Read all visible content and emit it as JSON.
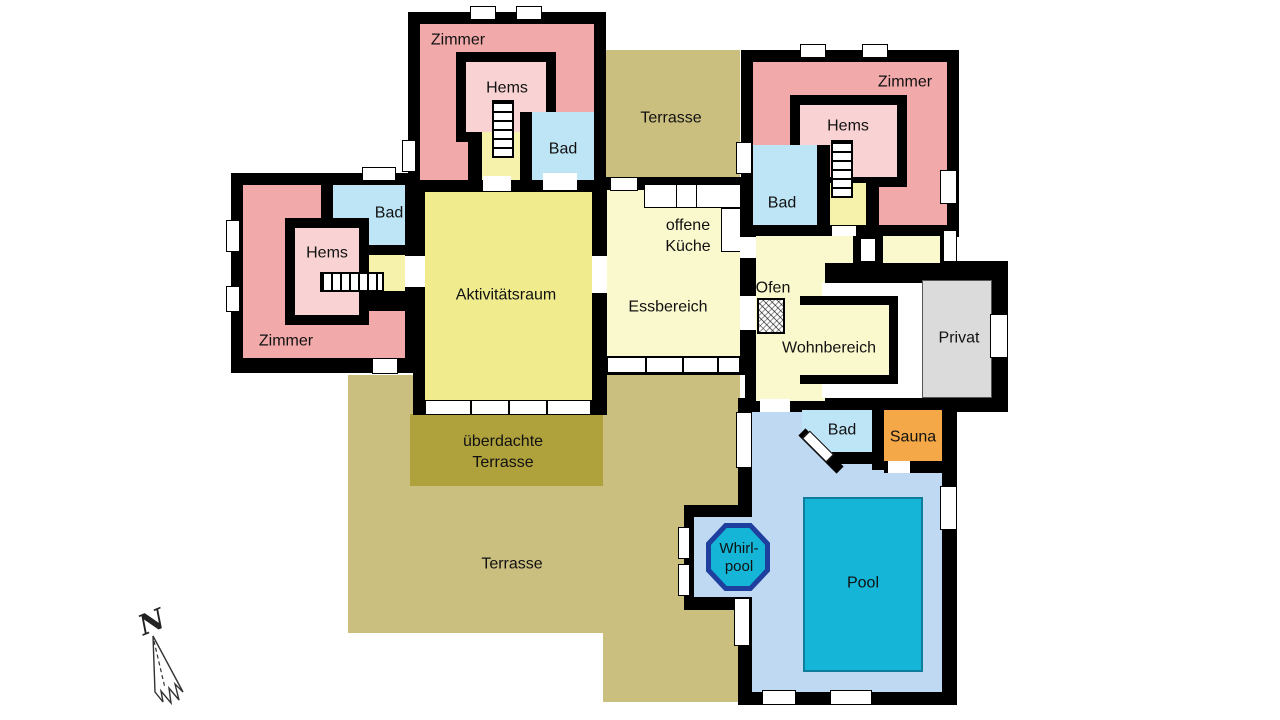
{
  "palette": {
    "wall": "#000000",
    "zimmer_pink": "#F2A9A9",
    "hems_pink": "#F9D3D3",
    "bad_blue": "#BEE5F6",
    "activity_yellow": "#F0EC8E",
    "pale_yellow": "#FAF8CD",
    "hall_yellow": "#F6F2AC",
    "terrace_khaki": "#CBBF80",
    "covered_terrace_khaki": "#AFA23D",
    "privat_gray": "#DBDBDB",
    "sauna_orange": "#F5A847",
    "pool_room_blue": "#BFD9F2",
    "pool_teal": "#14B5D6",
    "whirlpool_navy": "#1F3F9E"
  },
  "compass": {
    "label": "N"
  },
  "rooms": {
    "zimmer_top_left": {
      "label": "Zimmer"
    },
    "hems_top_left": {
      "label": "Hems"
    },
    "bad_top_left": {
      "label": "Bad"
    },
    "terrasse_top": {
      "label": "Terrasse"
    },
    "zimmer_top_right": {
      "label": "Zimmer"
    },
    "hems_top_right": {
      "label": "Hems"
    },
    "bad_top_right": {
      "label": "Bad"
    },
    "bad_mid_left": {
      "label": "Bad"
    },
    "hems_mid_left": {
      "label": "Hems"
    },
    "zimmer_mid_left": {
      "label": "Zimmer"
    },
    "aktivitaetsraum": {
      "label": "Aktivitätsraum"
    },
    "offene_kueche": {
      "line1": "offene",
      "line2": "Küche"
    },
    "essbereich": {
      "label": "Essbereich"
    },
    "ofen": {
      "label": "Ofen"
    },
    "wohnbereich": {
      "label": "Wohnbereich"
    },
    "privat": {
      "label": "Privat"
    },
    "bad_pool": {
      "label": "Bad"
    },
    "sauna": {
      "label": "Sauna"
    },
    "whirlpool": {
      "line1": "Whirl-",
      "line2": "pool"
    },
    "pool": {
      "label": "Pool"
    },
    "ueberdachte_terrasse": {
      "line1": "überdachte",
      "line2": "Terrasse"
    },
    "terrasse_bottom": {
      "label": "Terrasse"
    }
  }
}
